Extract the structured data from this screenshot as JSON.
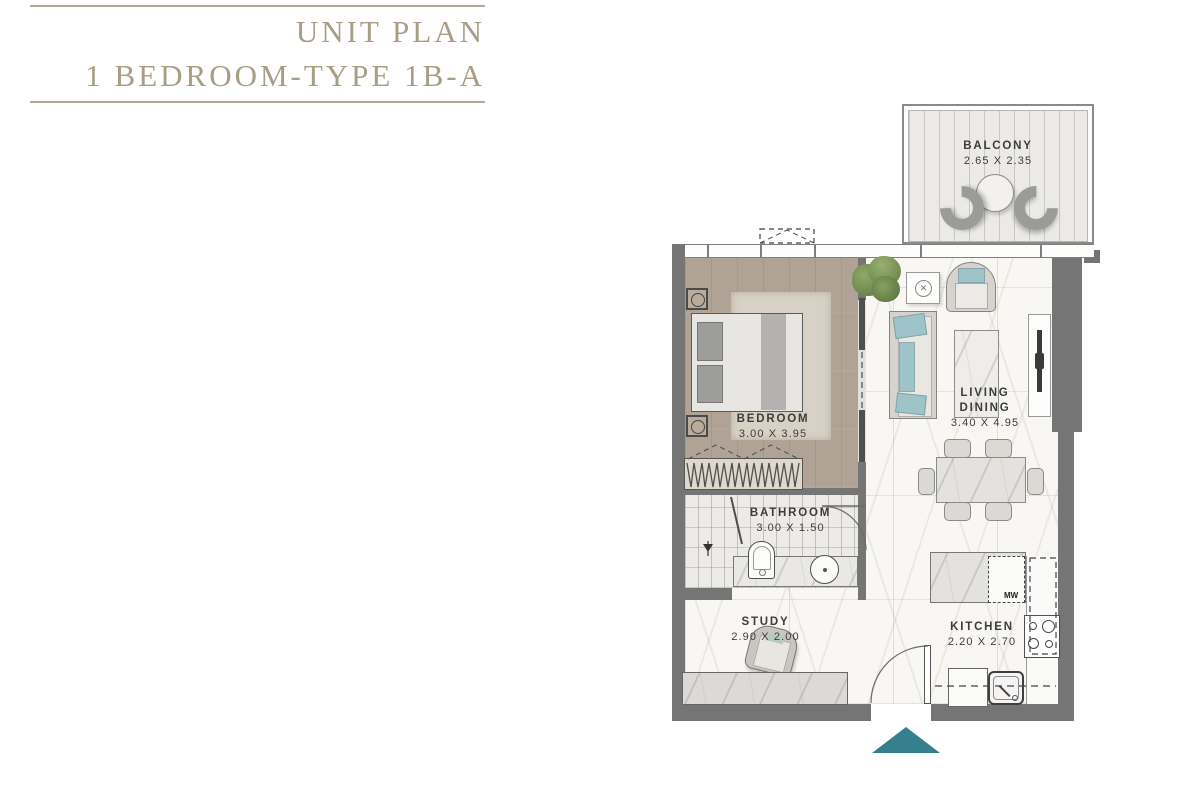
{
  "title": {
    "line1": "UNIT PLAN",
    "line2": "1 BEDROOM-TYPE 1B-A"
  },
  "rooms": {
    "balcony": {
      "name": "BALCONY",
      "dims": "2.65 X 2.35"
    },
    "bedroom": {
      "name": "BEDROOM",
      "dims": "3.00 X 3.95"
    },
    "living_dining": {
      "name_line1": "LIVING",
      "name_line2": "DINING",
      "dims": "3.40 X 4.95"
    },
    "bathroom": {
      "name": "BATHROOM",
      "dims": "3.00 X 1.50"
    },
    "study": {
      "name": "STUDY",
      "dims": "2.90 X 2.00"
    },
    "kitchen": {
      "name": "KITCHEN",
      "dims": "2.20 X 2.70",
      "microwave_label": "MW"
    }
  },
  "markers": {
    "entrance": "entrance-arrow"
  },
  "colors": {
    "title_text": "#a89d85",
    "rule_line": "#b4aa94",
    "wall": "#757575",
    "accent_teal": "#36808d",
    "cushion_teal": "#9ec3c8",
    "label_text": "#3c3c3c",
    "wood_floor": "#b0a294",
    "marble_floor": "#f8f7f4"
  }
}
